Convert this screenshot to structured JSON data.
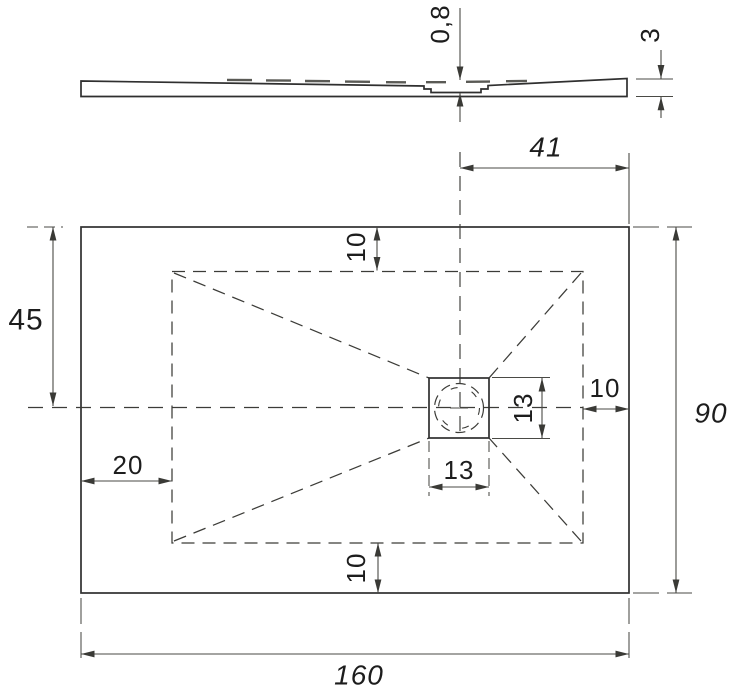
{
  "side_view": {
    "recess_depth": "0,8",
    "edge_thickness": "3"
  },
  "plan_view": {
    "drain_center_from_right": "41",
    "half_height": "45",
    "inset_top": "10",
    "inset_right": "10",
    "drain_size_vertical": "13",
    "drain_size_horizontal": "13",
    "left_to_inner": "20",
    "inset_bottom": "10",
    "overall_height": "90",
    "overall_width": "160"
  }
}
